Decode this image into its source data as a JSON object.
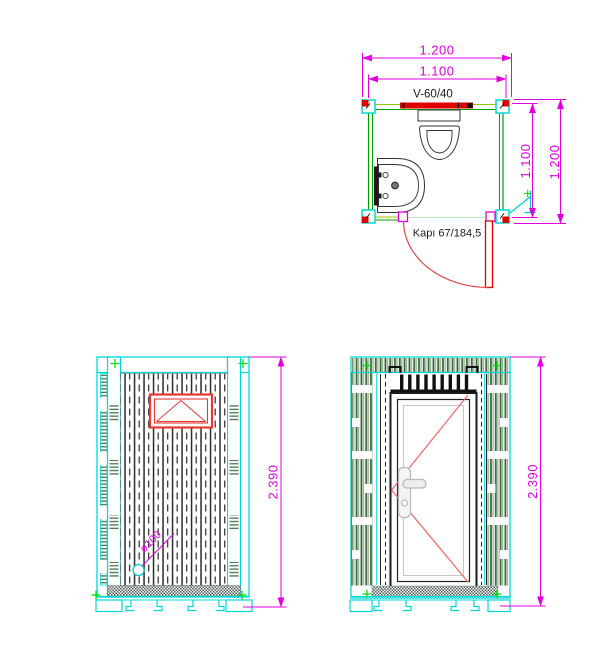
{
  "plan_view": {
    "window_label": "V-60/40",
    "door_label": "Kapı 67/184,5",
    "dim_width_outer": "1.200",
    "dim_width_inner": "1.100",
    "dim_depth_inner": "1.100",
    "dim_depth_outer": "1.200"
  },
  "side_elevation": {
    "dim_height": "2.390",
    "drain_label": "ø100"
  },
  "front_elevation": {
    "dim_height": "2.390"
  },
  "colors": {
    "dimension_magenta": "#e000e0",
    "frame_cyan": "#00d8d8",
    "wall_green": "#00a000",
    "wall_yellow_green": "#9ac400",
    "accent_red": "#e00000",
    "hatch_green": "#2f5e2f",
    "drawing_black": "#1a1a1a"
  }
}
